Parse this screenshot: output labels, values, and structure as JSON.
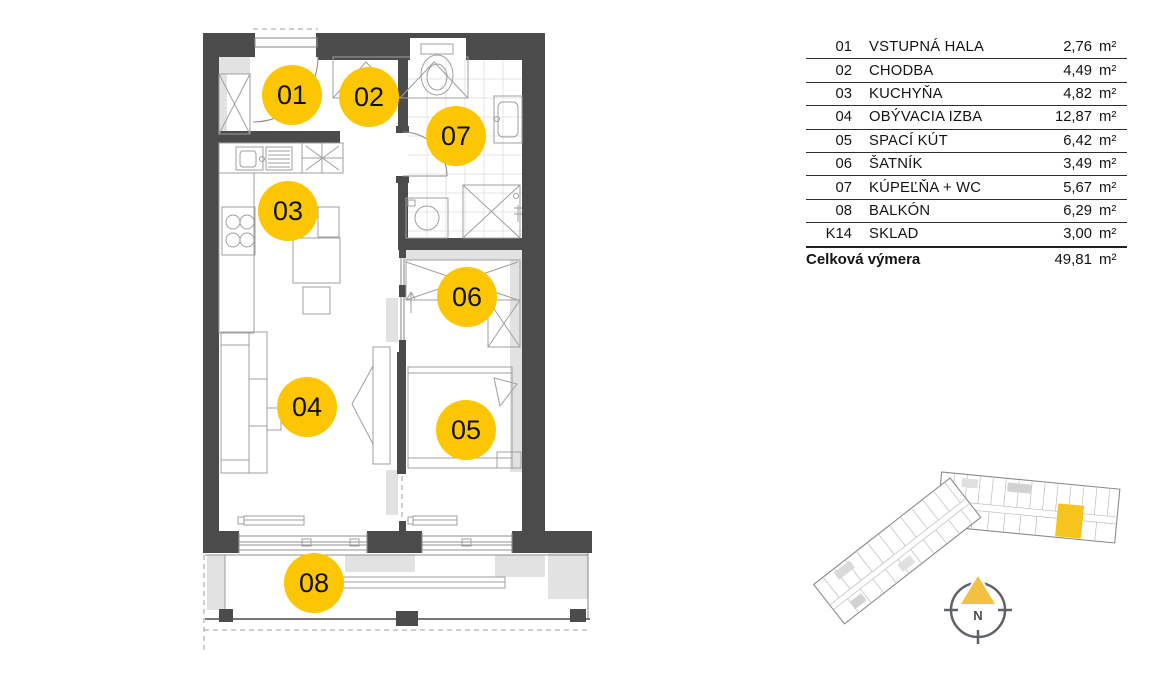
{
  "plan": {
    "wall_color": "#4b4b4b",
    "marker_color": "#fcc602",
    "marker_text_color": "#111111",
    "rooms": [
      {
        "label": "01"
      },
      {
        "label": "02"
      },
      {
        "label": "03"
      },
      {
        "label": "04"
      },
      {
        "label": "05"
      },
      {
        "label": "06"
      },
      {
        "label": "07"
      },
      {
        "label": "08"
      }
    ]
  },
  "legend": {
    "rows": [
      {
        "no": "01",
        "name": "VSTUPNÁ HALA",
        "area": "2,76",
        "unit": "m²"
      },
      {
        "no": "02",
        "name": "CHODBA",
        "area": "4,49",
        "unit": "m²"
      },
      {
        "no": "03",
        "name": "KUCHYŇA",
        "area": "4,82",
        "unit": "m²"
      },
      {
        "no": "04",
        "name": "OBÝVACIA IZBA",
        "area": "12,87",
        "unit": "m²"
      },
      {
        "no": "05",
        "name": "SPACÍ KÚT",
        "area": "6,42",
        "unit": "m²"
      },
      {
        "no": "06",
        "name": "ŠATNÍK",
        "area": "3,49",
        "unit": "m²"
      },
      {
        "no": "07",
        "name": "KÚPEĽŇA + WC",
        "area": "5,67",
        "unit": "m²"
      },
      {
        "no": "08",
        "name": "BALKÓN",
        "area": "6,29",
        "unit": "m²"
      },
      {
        "no": "K14",
        "name": "SKLAD",
        "area": "3,00",
        "unit": "m²"
      }
    ],
    "total": {
      "label": "Celková výmera",
      "area": "49,81",
      "unit": "m²"
    }
  },
  "minimap": {
    "highlight_color": "#f5c51d"
  },
  "compass": {
    "north_label": "N",
    "needle_color": "#f2c141"
  }
}
